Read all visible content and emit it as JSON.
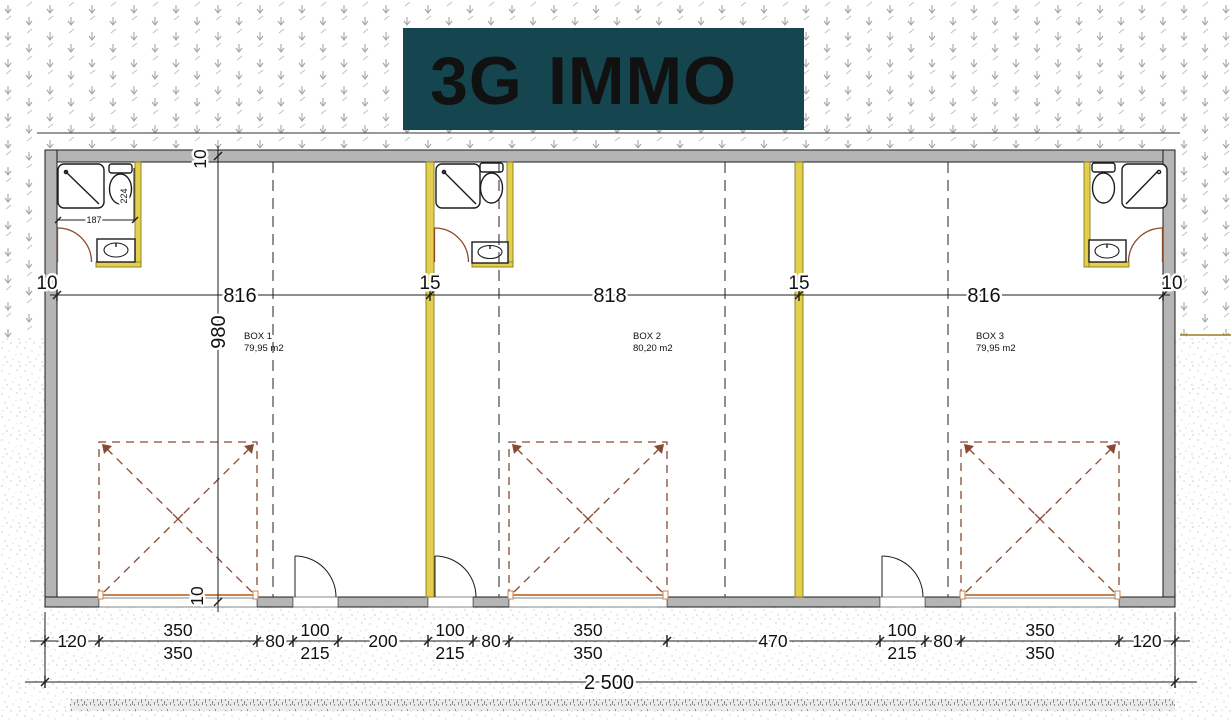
{
  "logo": {
    "brand_primary": "3G",
    "brand_secondary": "IMMO",
    "bg_color": "#15454e",
    "primary_color": "#ffffff",
    "secondary_color": "#58c314"
  },
  "units": [
    {
      "label": "BOX 1",
      "area": "79,95 m2"
    },
    {
      "label": "BOX 2",
      "area": "80,20 m2"
    },
    {
      "label": "BOX 3",
      "area": "79,95 m2"
    }
  ],
  "dimensions": {
    "interior_widths": {
      "left_wall": "10",
      "box1": "816",
      "partition1": "15",
      "box2": "818",
      "partition2": "15",
      "box3": "816",
      "right_wall": "10"
    },
    "interior_depth": {
      "top_wall": "10",
      "depth": "980",
      "bottom_wall": "10"
    },
    "bathroom": {
      "width": "187",
      "depth": "224"
    },
    "facade_chain": [
      {
        "value": "120"
      },
      {
        "value": "350",
        "value2": "350"
      },
      {
        "value": "80"
      },
      {
        "value": "100",
        "value2": "215"
      },
      {
        "value": "200"
      },
      {
        "value": "100",
        "value2": "215"
      },
      {
        "value": "80"
      },
      {
        "value": "350",
        "value2": "350"
      },
      {
        "value": "470"
      },
      {
        "value": "100",
        "value2": "215"
      },
      {
        "value": "80"
      },
      {
        "value": "350",
        "value2": "350"
      },
      {
        "value": "120"
      }
    ],
    "total_width": "2 500"
  }
}
